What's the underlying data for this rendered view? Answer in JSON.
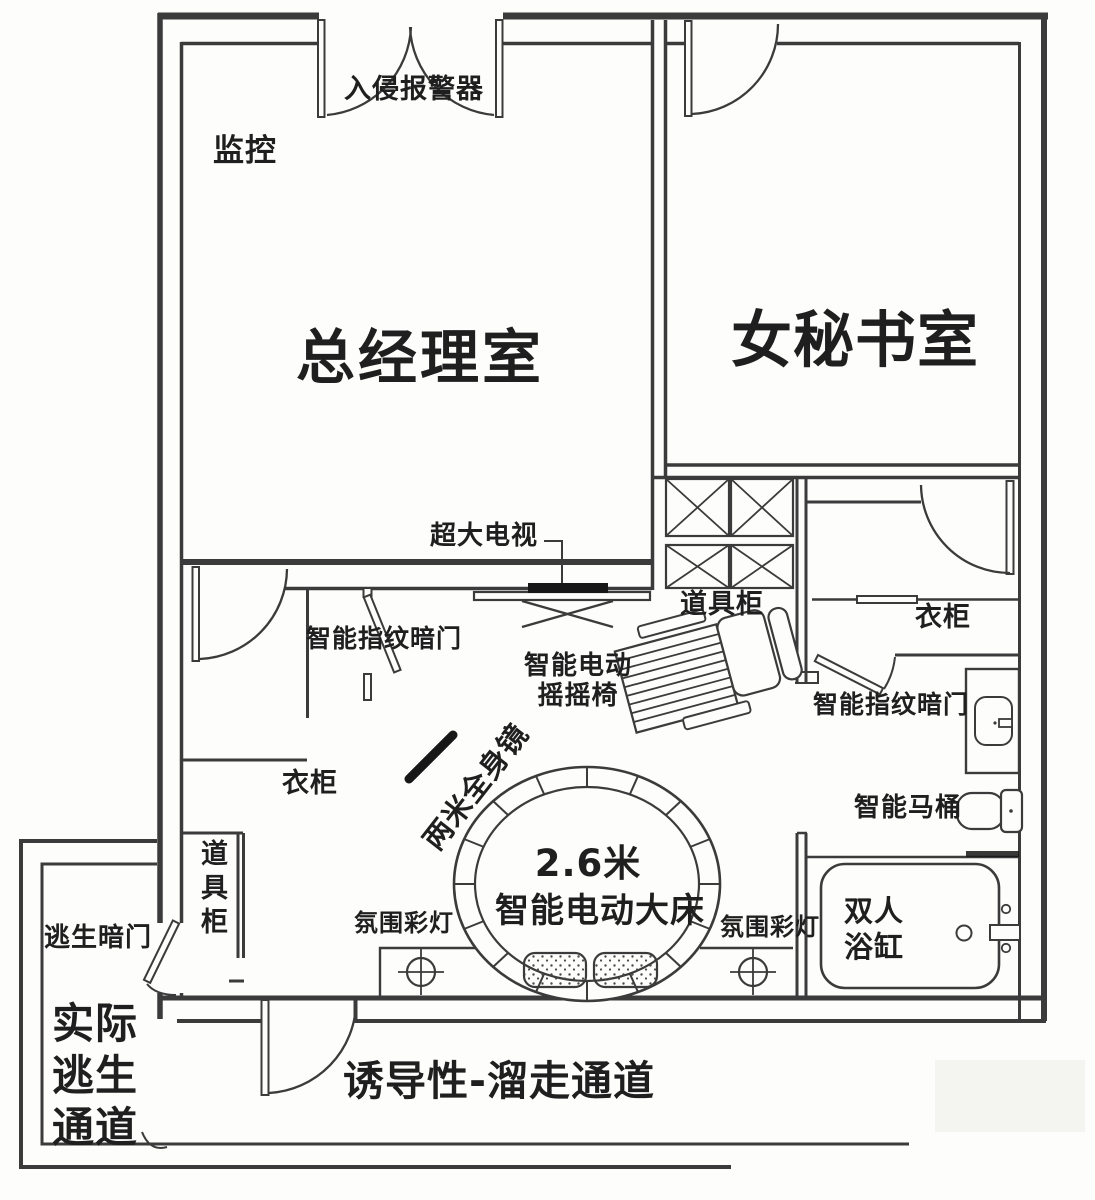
{
  "colors": {
    "line": "#3b3b3b",
    "dark": "#171717",
    "text": "#1f1f1f",
    "background": "#fdfdfc"
  },
  "floor_plan": {
    "rooms": {
      "gm_office": "总经理室",
      "secretary_room": "女秘书室"
    },
    "labels": {
      "intrusion_alarm": "入侵报警器",
      "surveillance": "监控",
      "big_tv": "超大电视",
      "prop_cabinet_right": "道具柜",
      "rocking_chair": "智能电动\n摇摇椅",
      "fingerprint_door_left": "智能指纹暗门",
      "fingerprint_door_right": "智能指纹暗门",
      "wardrobe_left": "衣柜",
      "wardrobe_right": "衣柜",
      "full_body_mirror": "两米全身镜",
      "bed_size": "2.6米",
      "smart_bed": "智能电动大床",
      "ambient_light_left": "氛围彩灯",
      "ambient_light_right": "氛围彩灯",
      "prop_cabinet_left": "道具柜",
      "escape_hidden_door": "逃生暗门",
      "actual_escape_passage": "实际\n逃生\n通道",
      "decoy_corridor": "诱导性-溜走通道",
      "smart_toilet": "智能马桶",
      "double_bathtub": "双人\n浴缸"
    }
  }
}
